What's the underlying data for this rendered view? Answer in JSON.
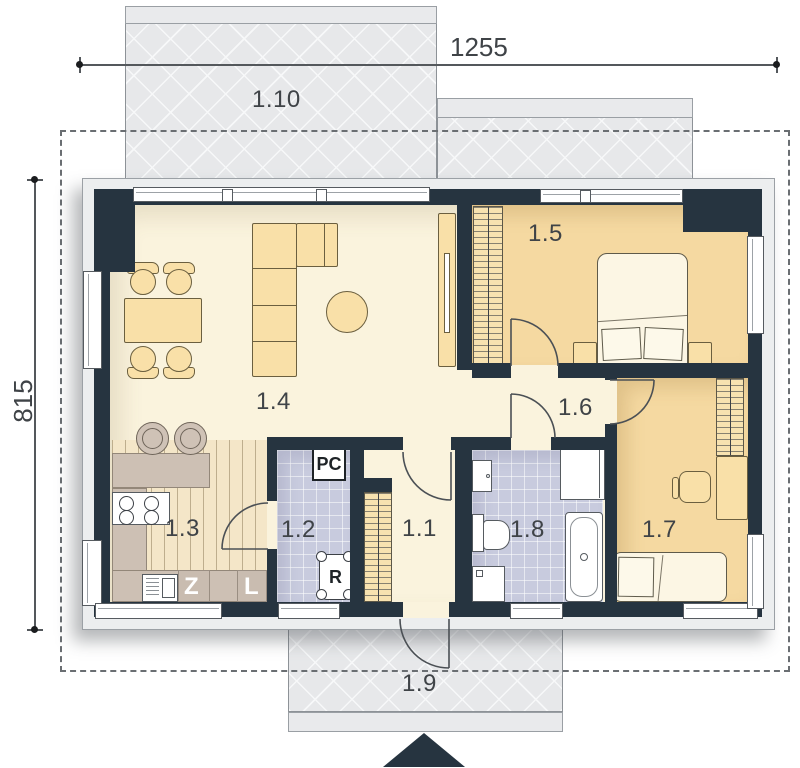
{
  "dimensions": {
    "top": "1255",
    "left": "815"
  },
  "rooms": {
    "r101": {
      "label": "1.1"
    },
    "r102": {
      "label": "1.2"
    },
    "r103": {
      "label": "1.3"
    },
    "r104": {
      "label": "1.4"
    },
    "r105": {
      "label": "1.5"
    },
    "r106": {
      "label": "1.6"
    },
    "r107": {
      "label": "1.7"
    },
    "r108": {
      "label": "1.8"
    },
    "r109": {
      "label": "1.9"
    },
    "r110": {
      "label": "1.10"
    }
  },
  "appliances": {
    "dishwasher": "Z",
    "fridge": "L",
    "boiler": "PC",
    "manifold": "R"
  },
  "colors": {
    "wall": "#263440",
    "floor_cream": "#faf3dd",
    "floor_orange": "#f5d9a1",
    "floor_tile": "#c8cbde",
    "counter_taupe": "#cdc0b4",
    "furniture_tan": "#f9e0a8",
    "exterior_gray": "#e7e8ea",
    "plinth_gray": "#eceeef"
  }
}
